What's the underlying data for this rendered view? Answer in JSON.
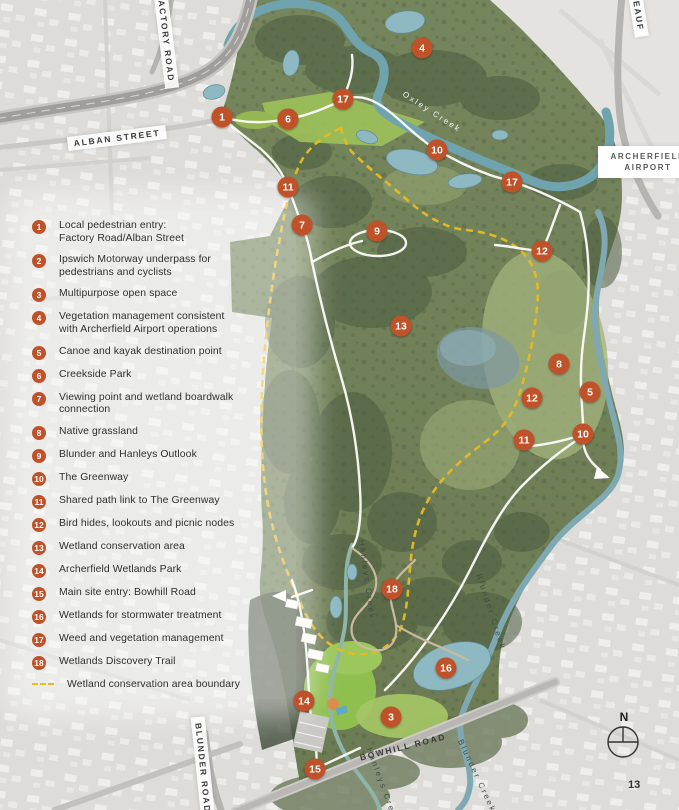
{
  "page": {
    "number": "13"
  },
  "colors": {
    "marker": "#bf5229",
    "boundary_dash": "#e7bb22",
    "water": "#8fb9c2",
    "park_green": "#72815c"
  },
  "legend": {
    "items": [
      {
        "num": "1",
        "label": "Local pedestrian entry:\nFactory Road/Alban Street"
      },
      {
        "num": "2",
        "label": "Ipswich Motorway underpass for\npedestrians and cyclists"
      },
      {
        "num": "3",
        "label": "Multipurpose open space"
      },
      {
        "num": "4",
        "label": "Vegetation management consistent\nwith Archerfield Airport operations"
      },
      {
        "num": "5",
        "label": "Canoe and kayak destination point"
      },
      {
        "num": "6",
        "label": "Creekside Park"
      },
      {
        "num": "7",
        "label": "Viewing point and wetland boardwalk\nconnection"
      },
      {
        "num": "8",
        "label": "Native grassland"
      },
      {
        "num": "9",
        "label": "Blunder and Hanleys Outlook"
      },
      {
        "num": "10",
        "label": "The Greenway"
      },
      {
        "num": "11",
        "label": "Shared path link to The Greenway"
      },
      {
        "num": "12",
        "label": "Bird hides, lookouts and picnic nodes"
      },
      {
        "num": "13",
        "label": "Wetland conservation area"
      },
      {
        "num": "14",
        "label": "Archerfield Wetlands Park"
      },
      {
        "num": "15",
        "label": "Main site entry: Bowhill Road"
      },
      {
        "num": "16",
        "label": "Wetlands for stormwater treatment"
      },
      {
        "num": "17",
        "label": "Weed and vegetation management"
      },
      {
        "num": "18",
        "label": "Wetlands Discovery Trail"
      }
    ],
    "boundary_label": "Wetland conservation area boundary"
  },
  "map": {
    "markers": [
      {
        "n": "1",
        "x": 222,
        "y": 117
      },
      {
        "n": "6",
        "x": 288,
        "y": 119
      },
      {
        "n": "17",
        "x": 343,
        "y": 99
      },
      {
        "n": "4",
        "x": 422,
        "y": 48
      },
      {
        "n": "10",
        "x": 437,
        "y": 150
      },
      {
        "n": "17",
        "x": 512,
        "y": 182
      },
      {
        "n": "11",
        "x": 288,
        "y": 187
      },
      {
        "n": "7",
        "x": 302,
        "y": 225
      },
      {
        "n": "9",
        "x": 377,
        "y": 231
      },
      {
        "n": "12",
        "x": 542,
        "y": 251
      },
      {
        "n": "13",
        "x": 401,
        "y": 326
      },
      {
        "n": "8",
        "x": 559,
        "y": 364
      },
      {
        "n": "5",
        "x": 590,
        "y": 392
      },
      {
        "n": "12",
        "x": 532,
        "y": 398
      },
      {
        "n": "10",
        "x": 583,
        "y": 434
      },
      {
        "n": "11",
        "x": 524,
        "y": 440
      },
      {
        "n": "18",
        "x": 392,
        "y": 589
      },
      {
        "n": "16",
        "x": 446,
        "y": 668
      },
      {
        "n": "14",
        "x": 304,
        "y": 701
      },
      {
        "n": "3",
        "x": 391,
        "y": 717
      },
      {
        "n": "15",
        "x": 315,
        "y": 769
      }
    ],
    "road_labels": [
      {
        "id": "factory-road",
        "text": "FACTORY ROAD",
        "x": 166,
        "y": 38,
        "rot": 83,
        "plate": true
      },
      {
        "id": "alban-street",
        "text": "ALBAN STREET",
        "x": 117,
        "y": 138,
        "rot": -7,
        "plate": true
      },
      {
        "id": "beaufighter",
        "text": "BEAUF",
        "x": 638,
        "y": 12,
        "rot": 81,
        "plate": true
      },
      {
        "id": "bowhill-road",
        "text": "BOWHILL ROAD",
        "x": 403,
        "y": 747,
        "rot": -14,
        "plate": false
      },
      {
        "id": "blunder-road",
        "text": "BLUNDER ROAD",
        "x": 203,
        "y": 768,
        "rot": 84,
        "plate": true
      }
    ],
    "creek_labels": [
      {
        "id": "oxley-creek",
        "text": "Oxley Creek",
        "x": 432,
        "y": 112,
        "rot": 33,
        "tone": "light"
      },
      {
        "id": "hanleys-creek-upper",
        "text": "Hanleys Creek",
        "x": 367,
        "y": 580,
        "rot": 82,
        "tone": "dark"
      },
      {
        "id": "blunder-creek-upper",
        "text": "Blunder Creek",
        "x": 491,
        "y": 612,
        "rot": 72,
        "tone": "dark"
      },
      {
        "id": "hanleys-creek-lower",
        "text": "Hanleys Creek",
        "x": 383,
        "y": 786,
        "rot": 70,
        "tone": "dark"
      },
      {
        "id": "blunder-creek-lower",
        "text": "Blunder Creek",
        "x": 477,
        "y": 776,
        "rot": 65,
        "tone": "dark"
      }
    ],
    "airport_label": {
      "line1": "ARCHERFIELD",
      "line2": "AIRPORT"
    },
    "compass": {
      "north": "N"
    }
  }
}
